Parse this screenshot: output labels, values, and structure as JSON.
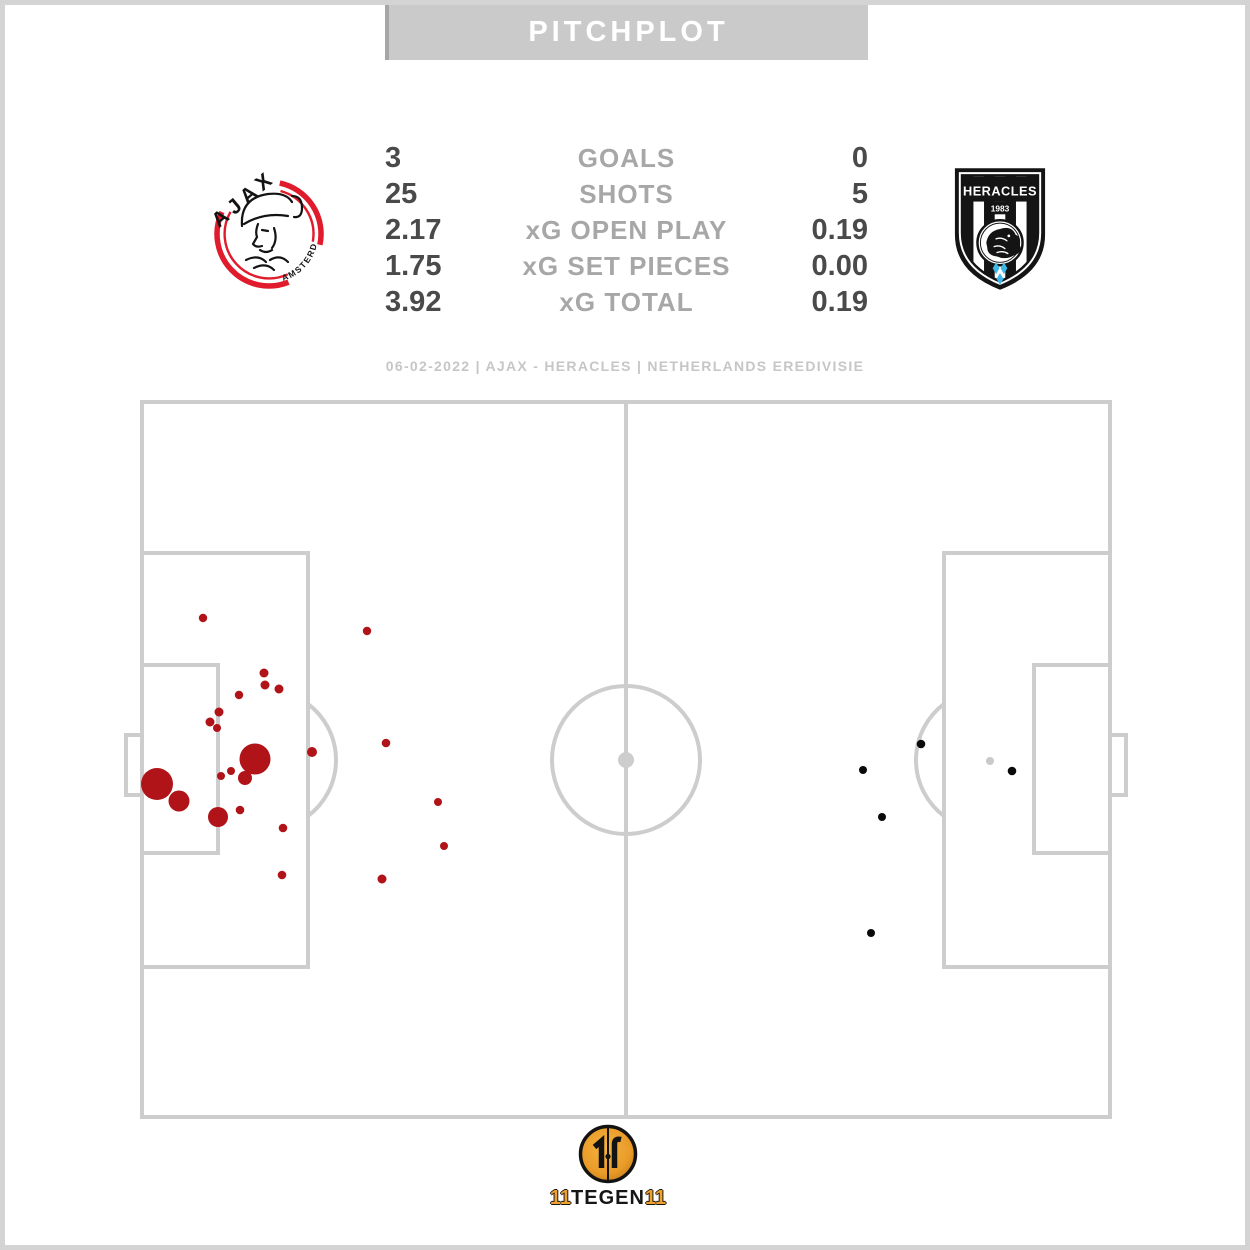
{
  "header": {
    "title": "PITCHPLOT"
  },
  "subtitle": "06-02-2022 | AJAX - HERACLES | NETHERLANDS EREDIVISIE",
  "teams": {
    "home": {
      "name": "AJAX",
      "crest_text": "AJAX",
      "crest_subtext": "AMSTERDAM"
    },
    "away": {
      "name": "HERACLES",
      "crest_text": "HERACLES",
      "crest_year": "1983"
    }
  },
  "stats": {
    "rows": [
      {
        "home": "3",
        "label": "GOALS",
        "away": "0"
      },
      {
        "home": "25",
        "label": "SHOTS",
        "away": "5"
      },
      {
        "home": "2.17",
        "label": "xG OPEN PLAY",
        "away": "0.19"
      },
      {
        "home": "1.75",
        "label": "xG SET PIECES",
        "away": "0.00"
      },
      {
        "home": "3.92",
        "label": "xG TOTAL",
        "away": "0.19"
      }
    ]
  },
  "footer": {
    "brand_parts": [
      "11",
      "TEGEN",
      "11"
    ]
  },
  "colors": {
    "header_bg": "#cacaca",
    "pitch_lines": "#cdcdcd",
    "home_shots": "#b01318",
    "away_shots": "#0a0a0a",
    "neutral_shot": "#c9c9c9",
    "ajax_red": "#e01b2c",
    "heracles_blue": "#3db7e8",
    "brand_gold": "#efa02e"
  },
  "chart_data": {
    "type": "scatter",
    "title": "PITCHPLOT",
    "subtitle": "06-02-2022 | AJAX - HERACLES | NETHERLANDS EREDIVISIE",
    "note": "Shot map: marker radius proportional to xG of each shot; Ajax (red) attacking the left goal, Heracles (black) the right goal; one light-gray unattributed marker near right penalty spot",
    "coordinate_system": "page pixels; pitch bounds x 142-1110, y 402-1117, halfway line x 626",
    "legend_position": "none",
    "grid": false,
    "series": [
      {
        "name": "Ajax shots",
        "marker_name": "ajax-shot-marker",
        "color": "#b01318",
        "points": [
          [
            255,
            759,
            15.5
          ],
          [
            157,
            784,
            16
          ],
          [
            179,
            801,
            10.5
          ],
          [
            218,
            817,
            10
          ],
          [
            245,
            778,
            7
          ],
          [
            203,
            618,
            4.2
          ],
          [
            367,
            631,
            4.2
          ],
          [
            264,
            673,
            4.5
          ],
          [
            265,
            685,
            4.5
          ],
          [
            279,
            689,
            4.5
          ],
          [
            239,
            695,
            4.2
          ],
          [
            219,
            712,
            4.5
          ],
          [
            210,
            722,
            4.5
          ],
          [
            217,
            728,
            4
          ],
          [
            231,
            771,
            4
          ],
          [
            221,
            776,
            4
          ],
          [
            240,
            810,
            4.3
          ],
          [
            283,
            828,
            4.3
          ],
          [
            312,
            752,
            5
          ],
          [
            386,
            743,
            4.3
          ],
          [
            438,
            802,
            4
          ],
          [
            444,
            846,
            4
          ],
          [
            282,
            875,
            4.3
          ],
          [
            382,
            879,
            4.5
          ]
        ]
      },
      {
        "name": "Heracles shots",
        "marker_name": "heracles-shot-marker",
        "color": "#0a0a0a",
        "points": [
          [
            921,
            744,
            4.3
          ],
          [
            863,
            770,
            4
          ],
          [
            1012,
            771,
            4.3
          ],
          [
            882,
            817,
            4
          ],
          [
            871,
            933,
            4
          ]
        ]
      },
      {
        "name": "Unattributed marker",
        "marker_name": "neutral-shot-marker",
        "color": "#c9c9c9",
        "points": [
          [
            990,
            761,
            4
          ]
        ]
      }
    ],
    "stats_table": {
      "columns": [
        "AJAX",
        "METRIC",
        "HERACLES"
      ],
      "rows": [
        [
          "3",
          "GOALS",
          "0"
        ],
        [
          "25",
          "SHOTS",
          "5"
        ],
        [
          "2.17",
          "xG OPEN PLAY",
          "0.19"
        ],
        [
          "1.75",
          "xG SET PIECES",
          "0.00"
        ],
        [
          "3.92",
          "xG TOTAL",
          "0.19"
        ]
      ]
    }
  }
}
